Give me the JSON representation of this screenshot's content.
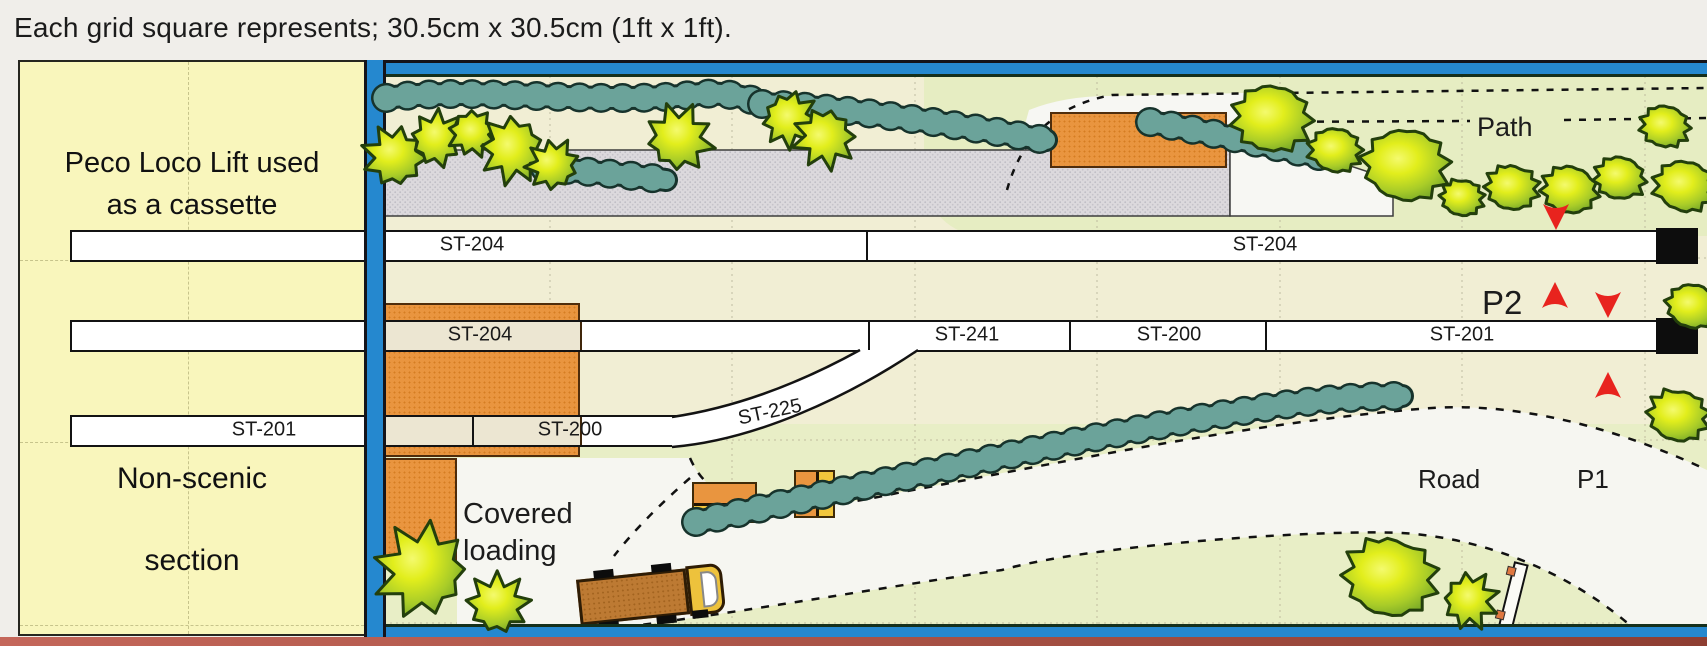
{
  "title": "Each grid square represents; 30.5cm x 30.5cm (1ft x 1ft).",
  "non_scenic_panel": {
    "note_lines": [
      "Peco Loco Lift used",
      "as a cassette",
      "to change tracks"
    ],
    "label_lines": [
      "Non-scenic",
      "section"
    ]
  },
  "tracks": {
    "siding_top": {
      "sections": [
        "ST-204",
        "ST-204"
      ]
    },
    "main_line": {
      "sections": [
        "ST-204",
        "ST-241",
        "ST-200",
        "ST-201"
      ]
    },
    "goods_line": {
      "sections": [
        "ST-201",
        "ST-200",
        "ST-225"
      ]
    }
  },
  "scene_labels": {
    "path": "Path",
    "platform2": "P2",
    "platform1": "P1",
    "road": "Road",
    "covered_loading_lines": [
      "Covered",
      "loading"
    ]
  },
  "colors": {
    "frame_blue": "#2588cf",
    "panel_yellow": "#f9f6bc",
    "building_orange": "#e9953f",
    "small_building_yellow": "#f2c63c",
    "hedge_teal": "#6ba39a",
    "tree_green": "#cfe43a",
    "track_white": "#ffffff",
    "arrow_red": "#e8231e",
    "platform_grey": "#dbd8db",
    "ground_cream": "#f1eed4",
    "ground_green": "#e8eec6",
    "road_white": "#f6f6f1",
    "buffer_black": "#0d0d0d",
    "truck_brown": "#bd7a33"
  }
}
